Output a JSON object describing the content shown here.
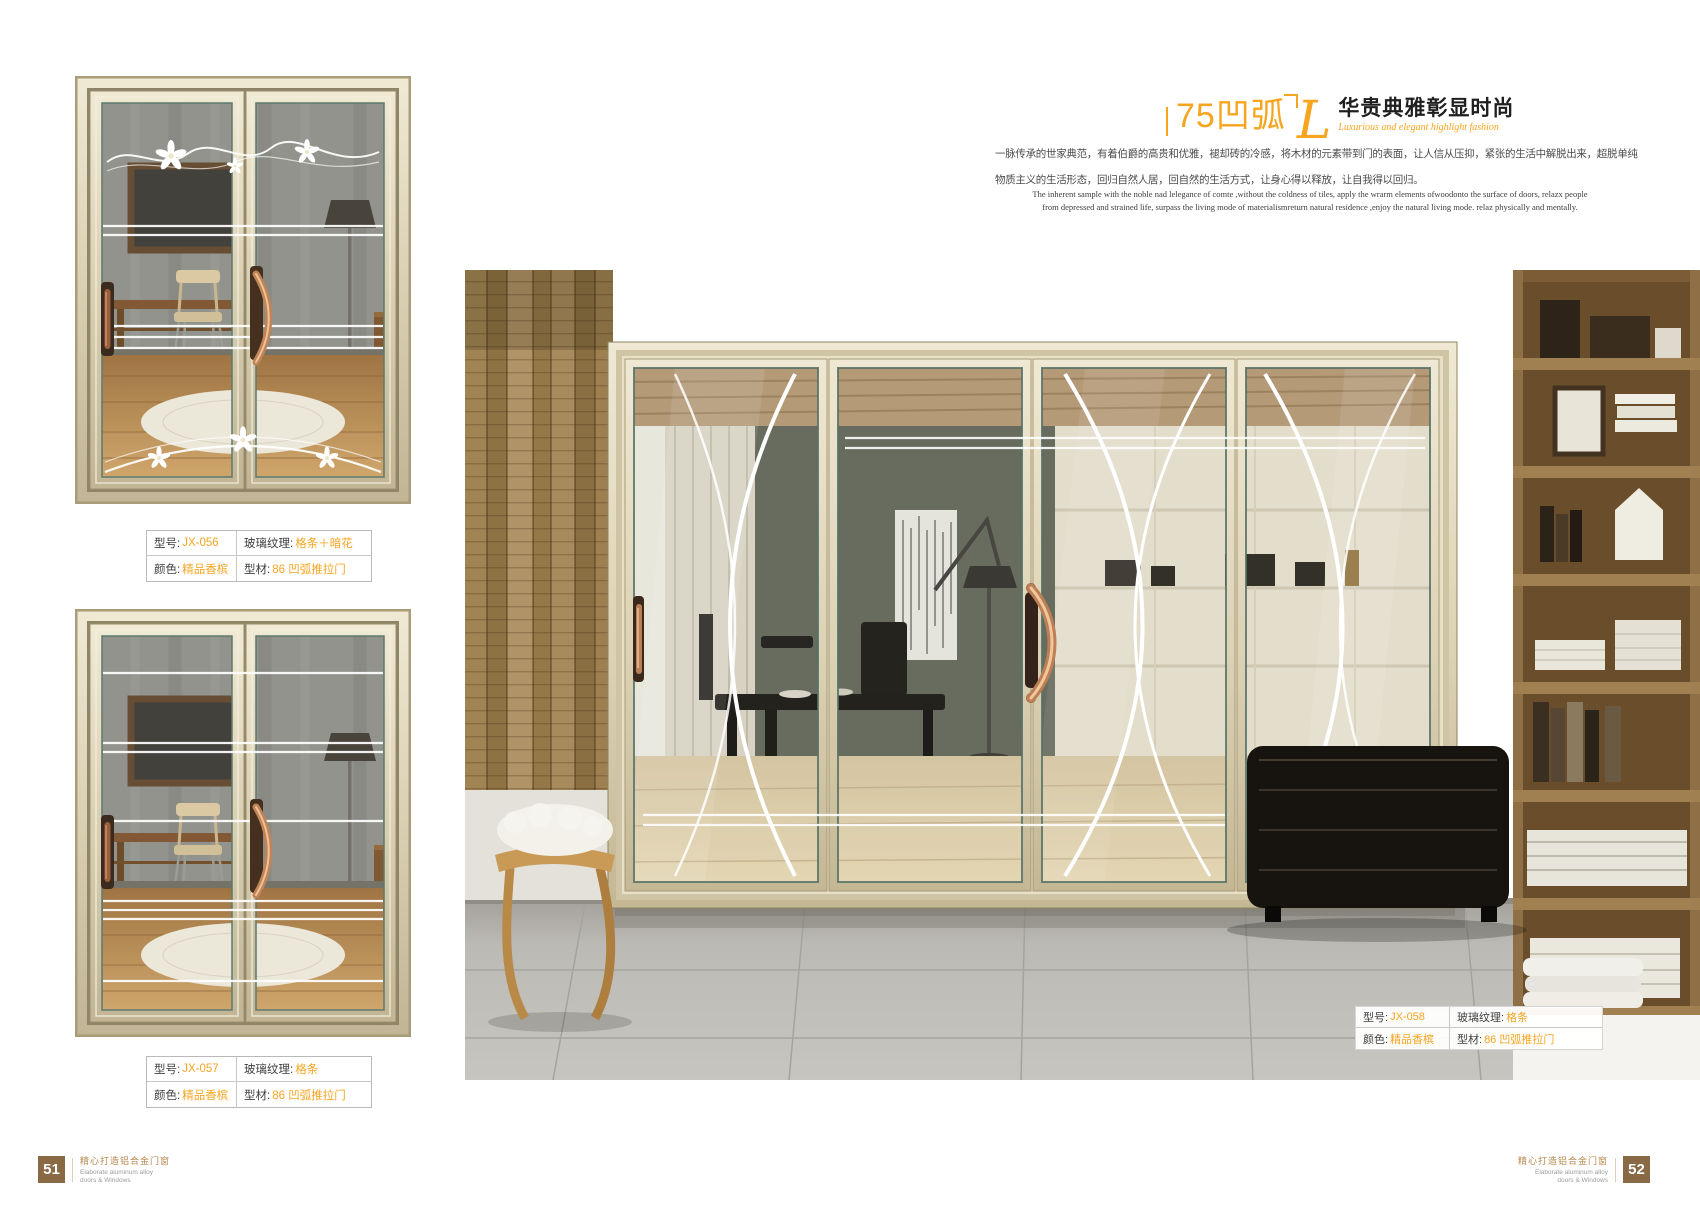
{
  "header": {
    "brand": "75凹弧",
    "script_initial": "L",
    "title": "华贵典雅彰显时尚",
    "subtitle": "Luxurious and elegant highlight fashion"
  },
  "intro": {
    "cn_line1": "一脉传承的世家典范，有着伯爵的高贵和优雅，褪却砖的冷感，将木材的元素带到门的表面，让人信从压抑，紧张的生活中解脱出来，超脱单纯",
    "cn_line2": "物质主义的生活形态，回归自然人居，回自然的生活方式，让身心得以释放，让自我得以回归。",
    "en_line1": "The inherent sample with the noble nad lelegance of comte ,without the coldness of tiles, apply the wrarm elements ofwoodonto the surface of doors, relazx people",
    "en_line2": "from depressed and strained life, surpass the living mode of materialismreturn natural residence ,enjoy the natural living mode. relaz physically and mentally."
  },
  "spec_labels": {
    "model": "型号:",
    "glass": "玻璃纹理:",
    "color": "颜色:",
    "profile": "型材:"
  },
  "products": [
    {
      "model": "JX-056",
      "glass": "格条＋暗花",
      "color": "精品香槟",
      "profile": "86 凹弧推拉门"
    },
    {
      "model": "JX-057",
      "glass": "格条",
      "color": "精品香槟",
      "profile": "86 凹弧推拉门"
    },
    {
      "model": "JX-058",
      "glass": "格条",
      "color": "精品香槟",
      "profile": "86 凹弧推拉门"
    }
  ],
  "footer": {
    "left_page": "51",
    "right_page": "52",
    "caption_cn": "精心打造铝合金门窗",
    "caption_en_line1": "Elaborate aluminum alloy",
    "caption_en_line2": "doors & Windows"
  },
  "colors": {
    "accent_orange": "#F7A41F",
    "footer_badge_brown": "#8A6A45",
    "frame_champagne": "#DDD3B8"
  }
}
